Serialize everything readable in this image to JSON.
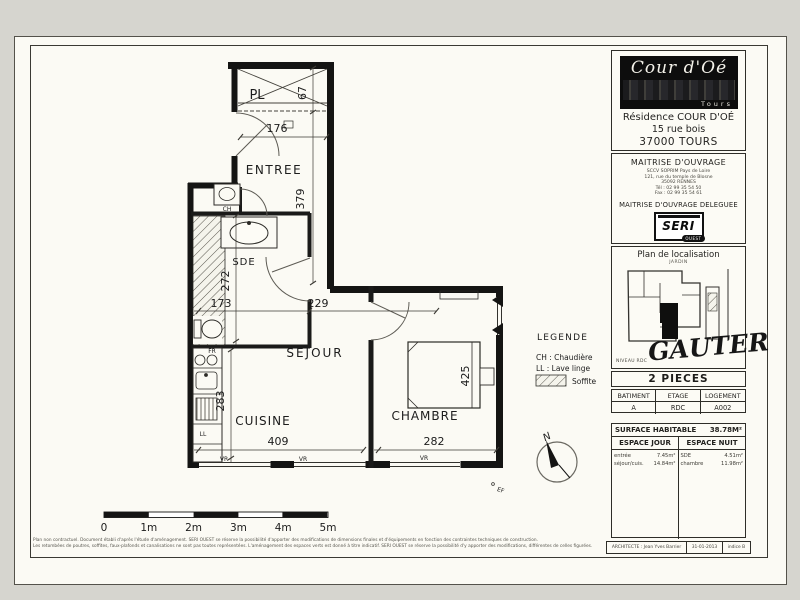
{
  "plan": {
    "rooms": {
      "pl": "PL",
      "entree": "ENTREE",
      "sde": "SDE",
      "sejour": "SEJOUR",
      "cuisine": "CUISINE",
      "chambre": "CHAMBRE"
    },
    "dims": {
      "pl_depth": "67",
      "entree_width": "176",
      "entree_height": "379",
      "sde_height": "272",
      "sde_width": "173",
      "sejour_width": "229",
      "cuisine_height": "283",
      "cuisine_width": "409",
      "chambre_width": "282",
      "chambre_height": "425"
    },
    "tags": {
      "ch": "CH",
      "fr": "FR",
      "ll": "LL",
      "vr": "VR",
      "ef": "EF"
    },
    "legend": {
      "title": "LEGENDE",
      "ch": "CH : Chaudière",
      "ll": "LL : Lave linge",
      "soffite": "Soffite"
    },
    "scale": {
      "labels": [
        "0",
        "1m",
        "2m",
        "3m",
        "4m",
        "5m"
      ]
    },
    "compass": {
      "north": "N"
    }
  },
  "sidebar": {
    "logo": {
      "name": "Cour d'Oé",
      "city": "Tours"
    },
    "residence": {
      "lines": [
        "Résidence COUR D'OÉ",
        "15 rue bois",
        "37000 TOURS"
      ]
    },
    "moa": {
      "title": "MAITRISE D'OUVRAGE",
      "lines": [
        "SCCV SOPRIM Pays de Loire",
        "121, rue du temple de Blosne",
        "35092 RENNES",
        "Tél : 02 99 35 54 50",
        "Fax : 02 99 35 54 61"
      ],
      "delegated_title": "MAITRISE D'OUVRAGE DELEGUEE",
      "seri": "SERI",
      "seri_sub": "OUEST"
    },
    "localisation": {
      "title": "Plan de localisation",
      "garden": "JARDIN",
      "level": "NIVEAU RDC",
      "handwritten": "GAUTER"
    },
    "unit_type": "2 PIECES",
    "unit_table": {
      "headers": [
        "BATIMENT",
        "ETAGE",
        "LOGEMENT"
      ],
      "values": [
        "A",
        "RDC",
        "A002"
      ]
    },
    "surface": {
      "title": "SURFACE HABITABLE",
      "total": "38.78M²",
      "day_header": "ESPACE JOUR",
      "night_header": "ESPACE NUIT",
      "day": [
        {
          "label": "entrée",
          "value": "7.45m²"
        },
        {
          "label": "séjour/cuis.",
          "value": "14.84m²"
        }
      ],
      "night": [
        {
          "label": "SDE",
          "value": "4.51m²"
        },
        {
          "label": "chambre",
          "value": "11.98m²"
        }
      ]
    },
    "architect": {
      "label": "ARCHITECTE : Jean Yves Barrier",
      "date": "31-01-2013",
      "index": "indice B"
    }
  },
  "footer": {
    "line1": "Plan non contractuel. Document établi d'après l'étude d'aménagement. SERI OUEST se réserve la possibilité d'apporter des modifications de dimensions finales et d'équipements en fonction des contraintes techniques de construction.",
    "line2": "Les retombées de poutres, soffites, faux-plafonds et canalisations ne sont pas toutes représentées. L'aménagement des espaces verts est donné à titre indicatif. SERI OUEST se réserve la possibilité d'y apporter des modifications, différentes de celles figurées."
  }
}
